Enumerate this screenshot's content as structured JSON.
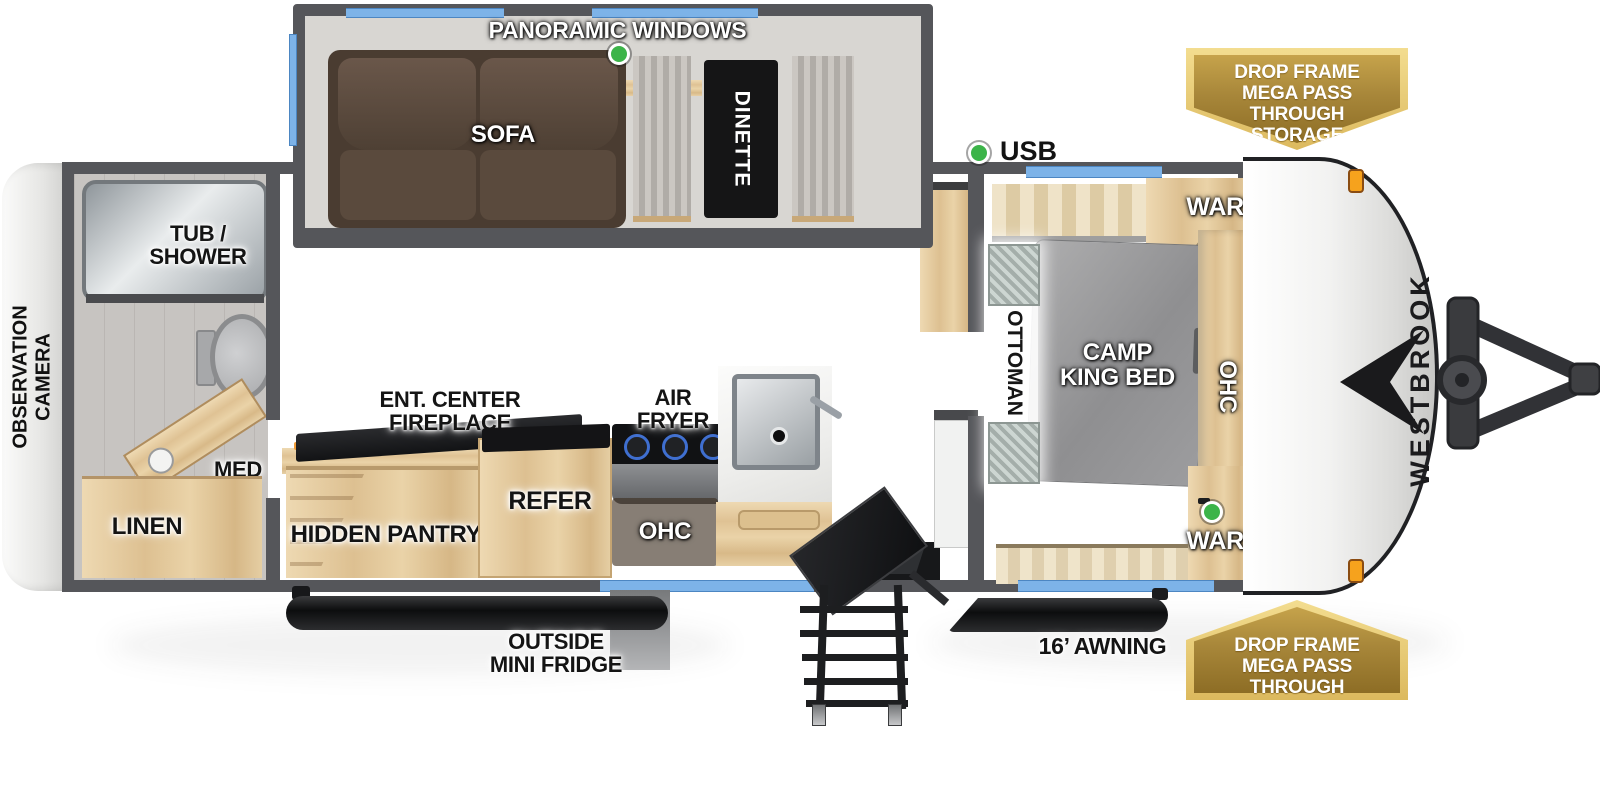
{
  "plan_title": "Westbrook travel trailer floorplan",
  "exterior": {
    "brand": "WESTBROOK",
    "rear_label_lines": [
      "OBSERVATION",
      "CAMERA"
    ],
    "awning_label": "16’ AWNING",
    "outside_fridge_lines": [
      "OUTSIDE",
      "MINI FRIDGE"
    ],
    "usb_label": "USB"
  },
  "badges": {
    "top": {
      "lines": [
        "DROP FRAME",
        "MEGA PASS THROUGH",
        "STORAGE"
      ]
    },
    "bottom": {
      "lines": [
        "DROP FRAME",
        "MEGA PASS THROUGH",
        "STORAGE"
      ]
    }
  },
  "living_area": {
    "window_label": "PANORAMIC WINDOWS",
    "sofa": "SOFA",
    "dinette": "DINETTE",
    "ent_center_lines": [
      "ENT. CENTER",
      "FIREPLACE"
    ],
    "hidden_pantry": "HIDDEN PANTRY"
  },
  "kitchen": {
    "air_fryer_lines": [
      "AIR",
      "FRYER"
    ],
    "refer": "REFER",
    "ohc": "OHC"
  },
  "bathroom": {
    "tub_shower_lines": [
      "TUB /",
      "SHOWER"
    ],
    "med": "MED",
    "linen": "LINEN"
  },
  "bedroom": {
    "bed_lines": [
      "CAMP",
      "KING BED"
    ],
    "ottoman": "OTTOMAN",
    "ohc": "OHC",
    "ward_top": "WARD",
    "ward_bottom": "WARD"
  },
  "colors": {
    "wall": "#55565a",
    "window_accent": "#7db3e8",
    "badge_gold": "#a8873a",
    "badge_trim": "#ecd27f",
    "usb_indicator_green": "#3cb449",
    "fireplace_flame": "#e8541f",
    "wood_cabinet": "#e3c99e",
    "marker_light_orange": "#f6a21d",
    "sofa_brown": "#4e4034",
    "bed_gray": "#9b9b9c"
  }
}
